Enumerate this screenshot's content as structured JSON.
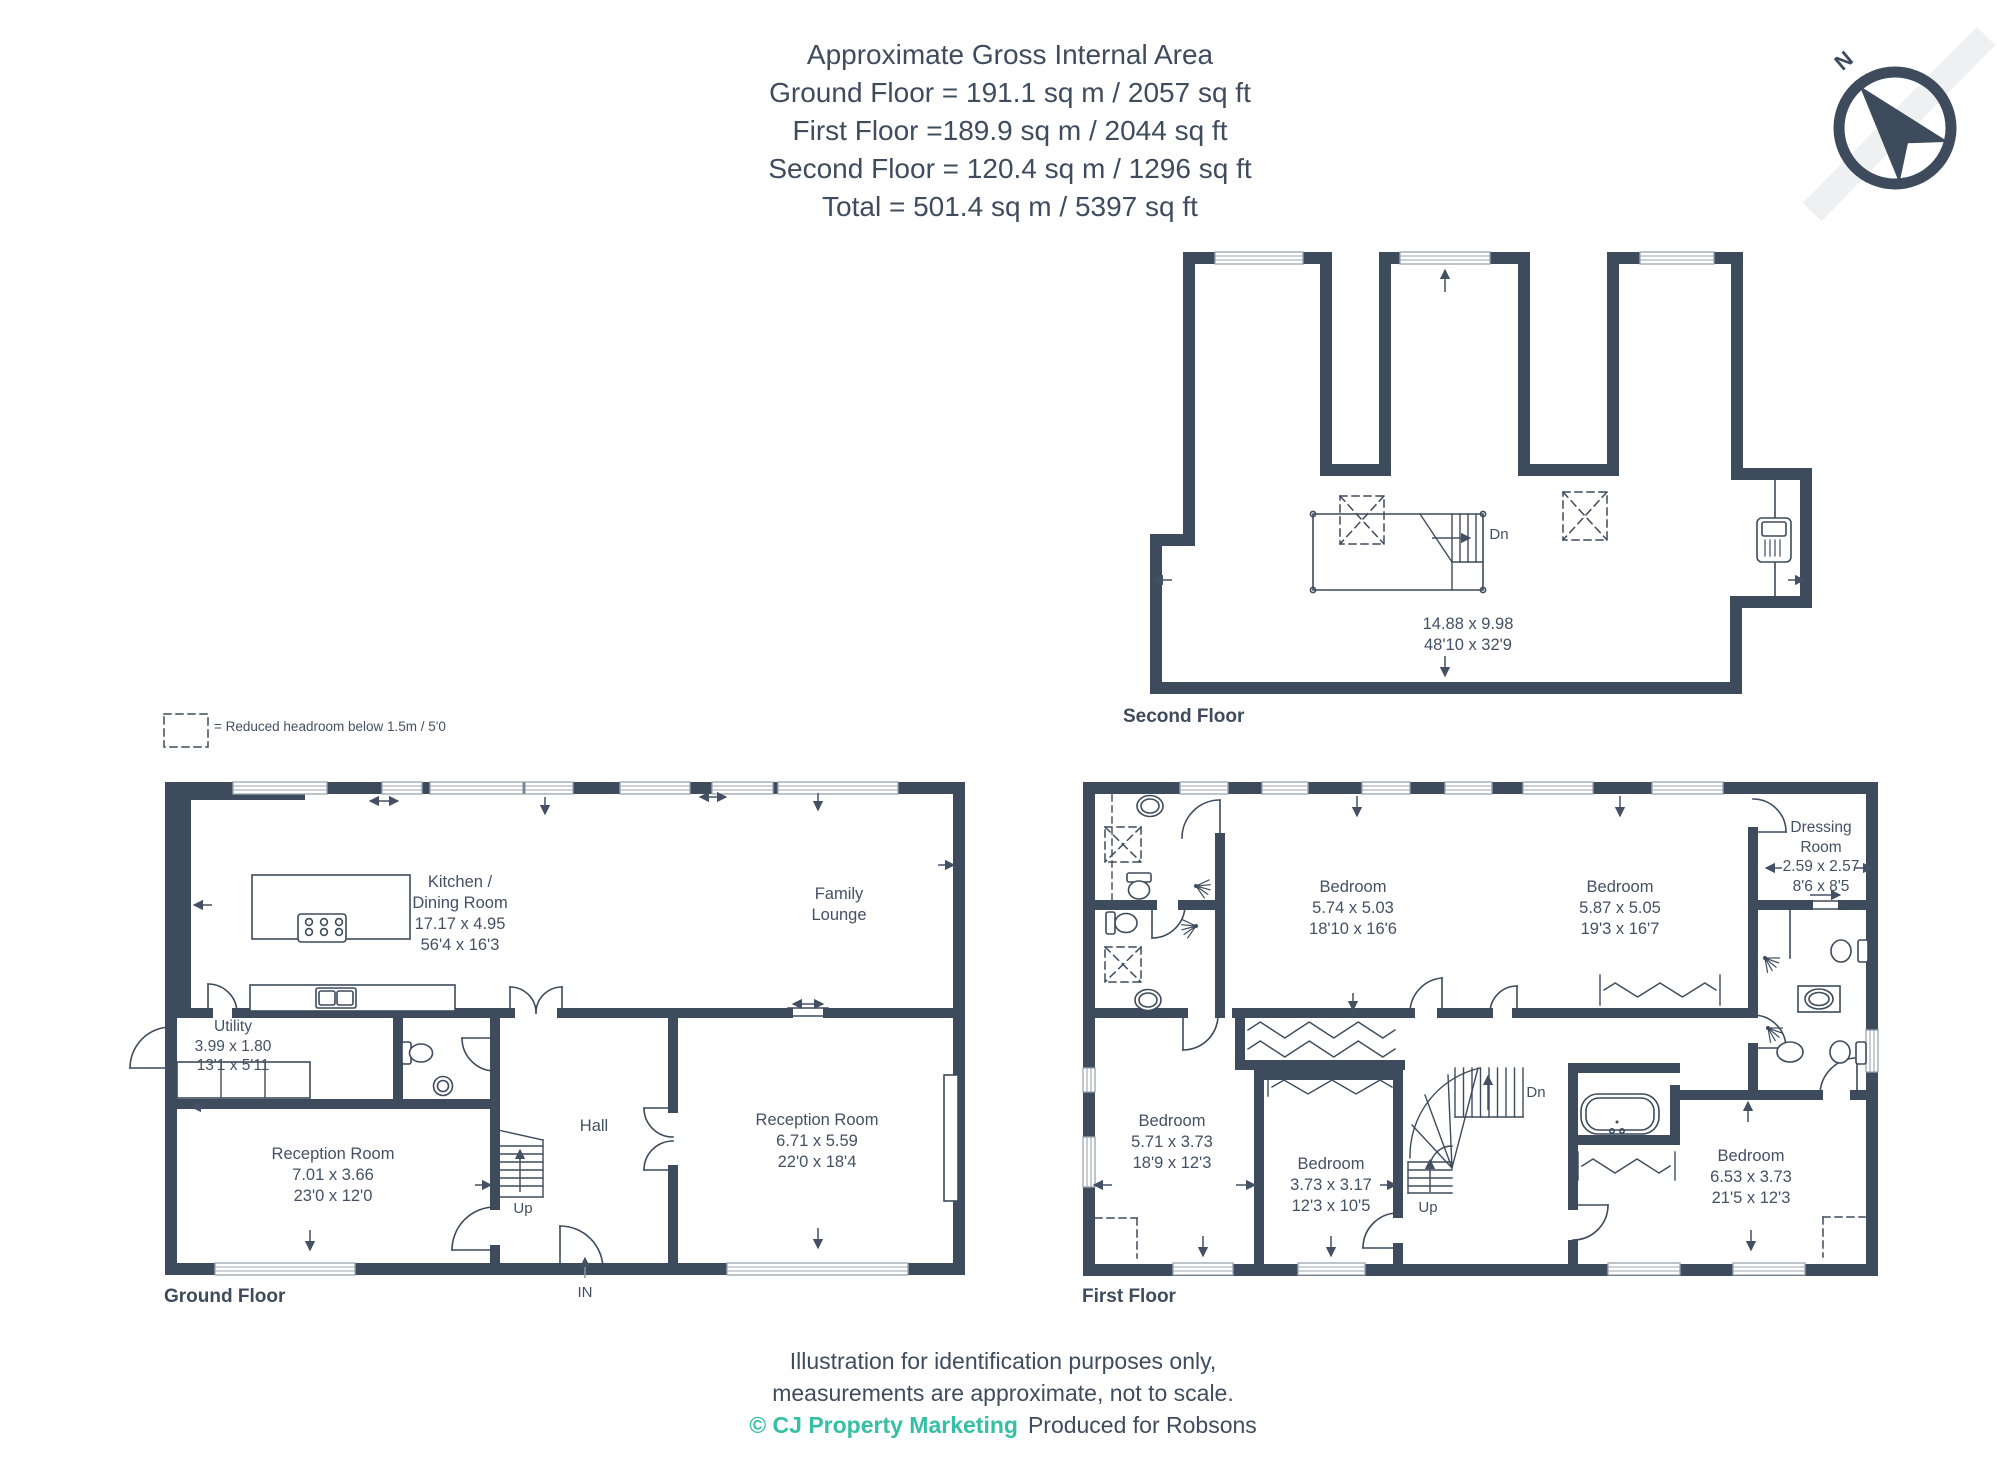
{
  "colors": {
    "wall": "#3d4b5c",
    "text": "#445064",
    "accent_teal": "#35bfa4",
    "window_line": "#9aa5b1"
  },
  "header": {
    "line1": "Approximate Gross Internal Area",
    "line2": "Ground Floor = 191.1 sq m / 2057 sq ft",
    "line3": "First Floor =189.9 sq m / 2044 sq ft",
    "line4": "Second Floor = 120.4 sq m / 1296 sq ft",
    "line5": "Total = 501.4 sq m / 5397 sq ft"
  },
  "compass": {
    "north": "N"
  },
  "legend": {
    "text": "= Reduced headroom below 1.5m / 5'0"
  },
  "second_floor": {
    "label": "Second Floor",
    "dims_m": "14.88 x 9.98",
    "dims_ft": "48'10 x 32'9",
    "stairs_down": "Dn"
  },
  "ground_floor": {
    "label": "Ground Floor",
    "entrance": "IN",
    "stairs_up": "Up",
    "kitchen": {
      "name_line1": "Kitchen /",
      "name_line2": "Dining Room",
      "dims_m": "17.17 x 4.95",
      "dims_ft": "56'4 x 16'3"
    },
    "family_lounge": {
      "name_line1": "Family",
      "name_line2": "Lounge"
    },
    "utility": {
      "name": "Utility",
      "dims_m": "3.99 x 1.80",
      "dims_ft": "13'1 x 5'11"
    },
    "hall": {
      "name": "Hall"
    },
    "reception_room_1": {
      "name": "Reception Room",
      "dims_m": "7.01 x 3.66",
      "dims_ft": "23'0 x 12'0"
    },
    "reception_room_2": {
      "name": "Reception Room",
      "dims_m": "6.71 x 5.59",
      "dims_ft": "22'0 x 18'4"
    }
  },
  "first_floor": {
    "label": "First Floor",
    "stairs_up": "Up",
    "stairs_down": "Dn",
    "bedroom_1": {
      "name": "Bedroom",
      "dims_m": "5.74 x 5.03",
      "dims_ft": "18'10 x 16'6"
    },
    "bedroom_2": {
      "name": "Bedroom",
      "dims_m": "5.87 x 5.05",
      "dims_ft": "19'3 x 16'7"
    },
    "dressing_room": {
      "name_line1": "Dressing",
      "name_line2": "Room",
      "dims_m": "2.59 x 2.57",
      "dims_ft": "8'6 x 8'5"
    },
    "bedroom_3": {
      "name": "Bedroom",
      "dims_m": "5.71 x 3.73",
      "dims_ft": "18'9 x 12'3"
    },
    "bedroom_4": {
      "name": "Bedroom",
      "dims_m": "3.73 x 3.17",
      "dims_ft": "12'3 x 10'5"
    },
    "bedroom_5": {
      "name": "Bedroom",
      "dims_m": "6.53 x 3.73",
      "dims_ft": "21'5 x 12'3"
    }
  },
  "footer": {
    "line1": "Illustration for identification purposes only,",
    "line2": "measurements are approximate, not to scale.",
    "credit": "© CJ Property Marketing",
    "produced": "Produced for Robsons"
  }
}
